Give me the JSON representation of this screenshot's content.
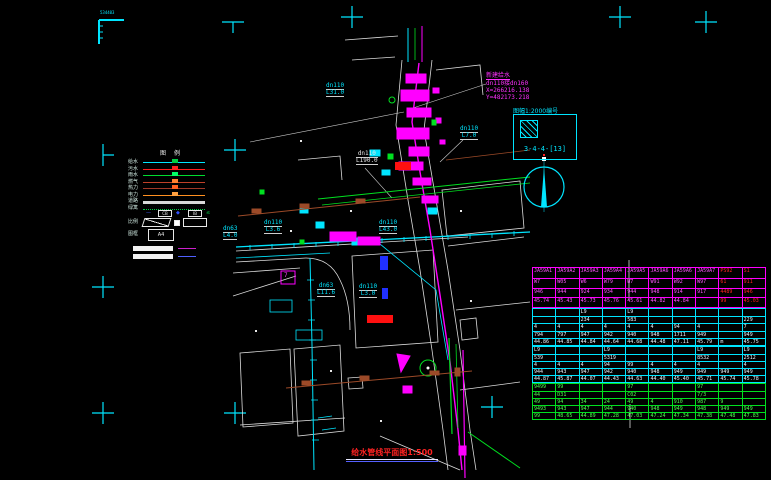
{
  "title": {
    "text": "给水管线平面图1:500"
  },
  "corner_mark": {
    "label": "534403"
  },
  "annotation": {
    "lines": [
      "新建给水",
      "dn110接dn160",
      "X=266216.138",
      "Y=482173.218"
    ],
    "color": "#ff30ff"
  },
  "index_box": {
    "label": "图幅1:2000编号",
    "code": "3-4-4-[13]"
  },
  "north_arrow": {
    "name": "north-arrow"
  },
  "legend": {
    "header": "图例",
    "items": [
      {
        "label": "给水",
        "color": "#00e5ff",
        "marker": "#00cc44"
      },
      {
        "label": "污水",
        "color": "#ff2020",
        "marker": "#ff2020"
      },
      {
        "label": "雨水",
        "color": "#00dd30",
        "marker": "#00ff66"
      },
      {
        "label": "燃气",
        "color": "#c04028",
        "marker": "#ff8030"
      },
      {
        "label": "热力",
        "color": "#a03828",
        "marker": "#ff6020"
      },
      {
        "label": "电力",
        "color": "#ff9020",
        "marker": "#ffa040"
      },
      {
        "label": "道路",
        "color": "#d8d8d8",
        "thick": true
      },
      {
        "label": "绿篱",
        "color": "#00cc44",
        "dotted": true
      }
    ],
    "symbols": [
      {
        "glyph": "—",
        "color": "#4060ff"
      },
      {
        "glyph": "CB",
        "box": true
      },
      {
        "glyph": "◆",
        "color": "#3050ff"
      },
      {
        "glyph": "IB",
        "box": true
      },
      {
        "glyph": "≤",
        "color": "#00cc44"
      }
    ],
    "scale_row_label": "比例",
    "frame_row_label": "图框",
    "frame_box_text": "A4"
  },
  "drawing": {
    "labels": [
      {
        "lines": [
          "534403"
        ],
        "x": 100,
        "y": 11,
        "color": "#00e5ff",
        "ul": false,
        "size": 4
      },
      {
        "lines": [
          "dn110",
          "L31.0"
        ],
        "x": 326,
        "y": 83,
        "color": "#00e5ff",
        "ul": true
      },
      {
        "lines": [
          "dn110",
          "L190.0"
        ],
        "x": 356,
        "y": 151,
        "color": "#e8e8e8",
        "ul": true
      },
      {
        "lines": [
          "dn110",
          "L7.0"
        ],
        "x": 460,
        "y": 126,
        "color": "#00e5ff",
        "ul": true
      },
      {
        "lines": [
          "dn63",
          "L4.0"
        ],
        "x": 223,
        "y": 226,
        "color": "#00e5ff",
        "ul": true
      },
      {
        "lines": [
          "dn110",
          "L3.6"
        ],
        "x": 264,
        "y": 220,
        "color": "#00e5ff",
        "ul": true
      },
      {
        "lines": [
          "dn110",
          "L43.0"
        ],
        "x": 379,
        "y": 220,
        "color": "#00e5ff",
        "ul": true
      },
      {
        "lines": [
          "dn63",
          "L11.6"
        ],
        "x": 317,
        "y": 283,
        "color": "#00e5ff",
        "ul": true
      },
      {
        "lines": [
          "dn110",
          "L3.0"
        ],
        "x": 359,
        "y": 284,
        "color": "#00e5ff",
        "ul": true
      },
      {
        "lines": [
          "7"
        ],
        "x": 284,
        "y": 273,
        "color": "#ff40ff",
        "ul": false
      }
    ]
  },
  "table": {
    "section_heights": [
      41,
      38,
      37,
      37
    ],
    "sections": [
      {
        "border": "#ff00ff",
        "text": "#ff55ff",
        "red_cols": [
          8,
          9
        ],
        "red": "#ff2222",
        "rows": [
          [
            "JA59A1",
            "JA59A2",
            "JA59A3",
            "JA59A4",
            "JA59A5",
            "JA59A6",
            "JA59A6",
            "JA59A7",
            "PS92",
            "S1"
          ],
          [
            "W7",
            "W05",
            "W6",
            "W79",
            "W7",
            "W91",
            "W92",
            "W97",
            "61",
            "911"
          ],
          [
            "946",
            "944",
            "924",
            "934",
            "944",
            "948",
            "914",
            "917",
            "4489",
            "946"
          ],
          [
            "45.74",
            "45.43",
            "45.73",
            "45.76",
            "45.61",
            "44.82",
            "44.84",
            "",
            "99",
            "45.03"
          ]
        ]
      },
      {
        "border": "#00e5ff",
        "text": "#e8f4ff",
        "rows": [
          [
            "",
            "",
            "L9",
            "",
            "L9",
            "",
            "",
            "",
            "",
            ""
          ],
          [
            "",
            "",
            "234",
            "",
            "583",
            "",
            "",
            "",
            "",
            "229"
          ],
          [
            "4",
            "4",
            "4",
            "4",
            "4",
            "4",
            "94",
            "4",
            "",
            "7"
          ],
          [
            "794",
            "797",
            "947",
            "942",
            "940",
            "948",
            "1711",
            "949",
            "",
            "949"
          ],
          [
            "44.86",
            "44.85",
            "44.84",
            "44.64",
            "44.68",
            "44.48",
            "47.11",
            "45.79",
            "m",
            "45.75"
          ]
        ]
      },
      {
        "border": "#00e5ff",
        "text": "#e8f4ff",
        "rows": [
          [
            "L9",
            "",
            "",
            "L9",
            "",
            "",
            "",
            "L9",
            "",
            "L9"
          ],
          [
            "539",
            "",
            "",
            "5319",
            "",
            "",
            "",
            "8532",
            "",
            "2512"
          ],
          [
            "4",
            "4",
            "4",
            "94",
            "99",
            "4",
            "4",
            "4",
            "",
            "4"
          ],
          [
            "944",
            "943",
            "947",
            "942",
            "940",
            "948",
            "949",
            "949",
            "949",
            "949"
          ],
          [
            "44.87",
            "45.87",
            "44.07",
            "44.43",
            "44.63",
            "44.40",
            "45.40",
            "45.71",
            "45.74",
            "45.78"
          ]
        ]
      },
      {
        "border": "#00e020",
        "text": "#50ff50",
        "rows": [
          [
            "9499",
            "99",
            "",
            "",
            "97",
            "",
            "",
            "97",
            "",
            ""
          ],
          [
            "44",
            "D31",
            "",
            "",
            "C02",
            "",
            "",
            "7/3",
            "",
            ""
          ],
          [
            "49",
            "94",
            "34",
            "24",
            "49",
            "4",
            "910",
            "987",
            "9",
            ""
          ],
          [
            "9493",
            "943",
            "947",
            "944",
            "940",
            "948",
            "949",
            "948",
            "949",
            "949"
          ],
          [
            "99",
            "48.65",
            "44.89",
            "47.28",
            "47.03",
            "47.24",
            "47.34",
            "47.38",
            "47.48",
            "47.83"
          ]
        ]
      }
    ]
  }
}
